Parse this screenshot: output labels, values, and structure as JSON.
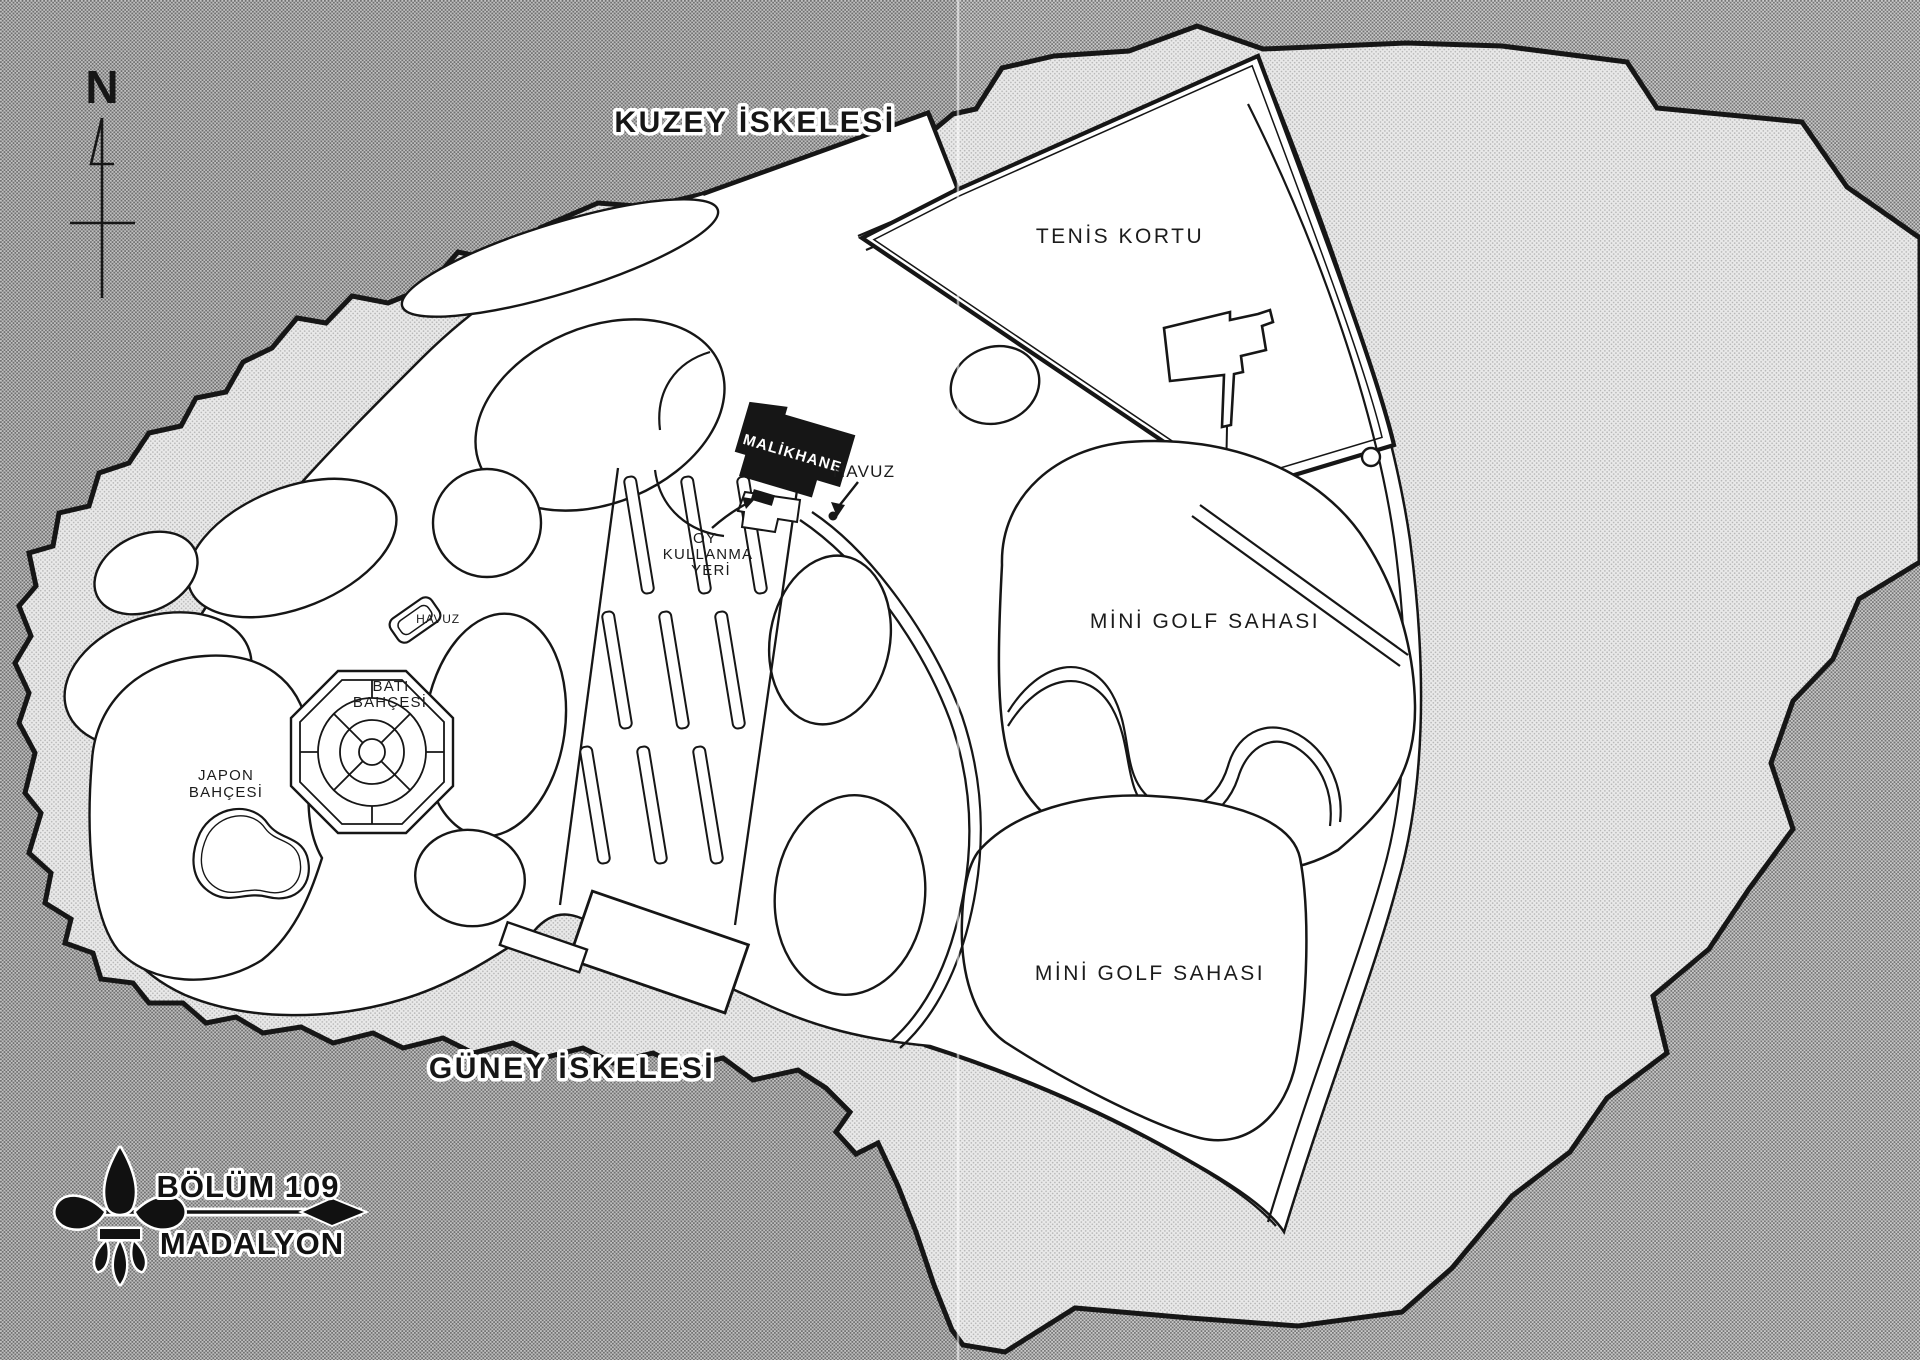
{
  "map": {
    "compass": {
      "label": "N"
    },
    "labels": {
      "north_pier": "KUZEY İSKELESİ",
      "south_pier": "GÜNEY İSKELESİ",
      "tennis_court": "TENİS KORTU",
      "mini_golf_north": "MİNİ GOLF SAHASI",
      "mini_golf_south": "MİNİ GOLF SAHASI",
      "mansion": "MALİKHANE",
      "pool_main": "HAVUZ",
      "pool_west": "HAVUZ",
      "voting_place": {
        "line1": "OY",
        "line2": "KULLANMA",
        "line3": "YERİ"
      },
      "west_garden": {
        "line1": "BATI",
        "line2": "BAHÇESİ"
      },
      "japanese_garden": {
        "line1": "JAPON",
        "line2": "BAHÇESİ"
      }
    },
    "chapter": {
      "number": "BÖLÜM 109",
      "title": "MADALYON"
    },
    "colors": {
      "ink": "#161616",
      "paper": "#ffffff",
      "water_base": "#cacaca",
      "water_dot": "#757575",
      "shore_base": "#e9e9e9",
      "shore_dot": "#b3b3b3"
    }
  }
}
